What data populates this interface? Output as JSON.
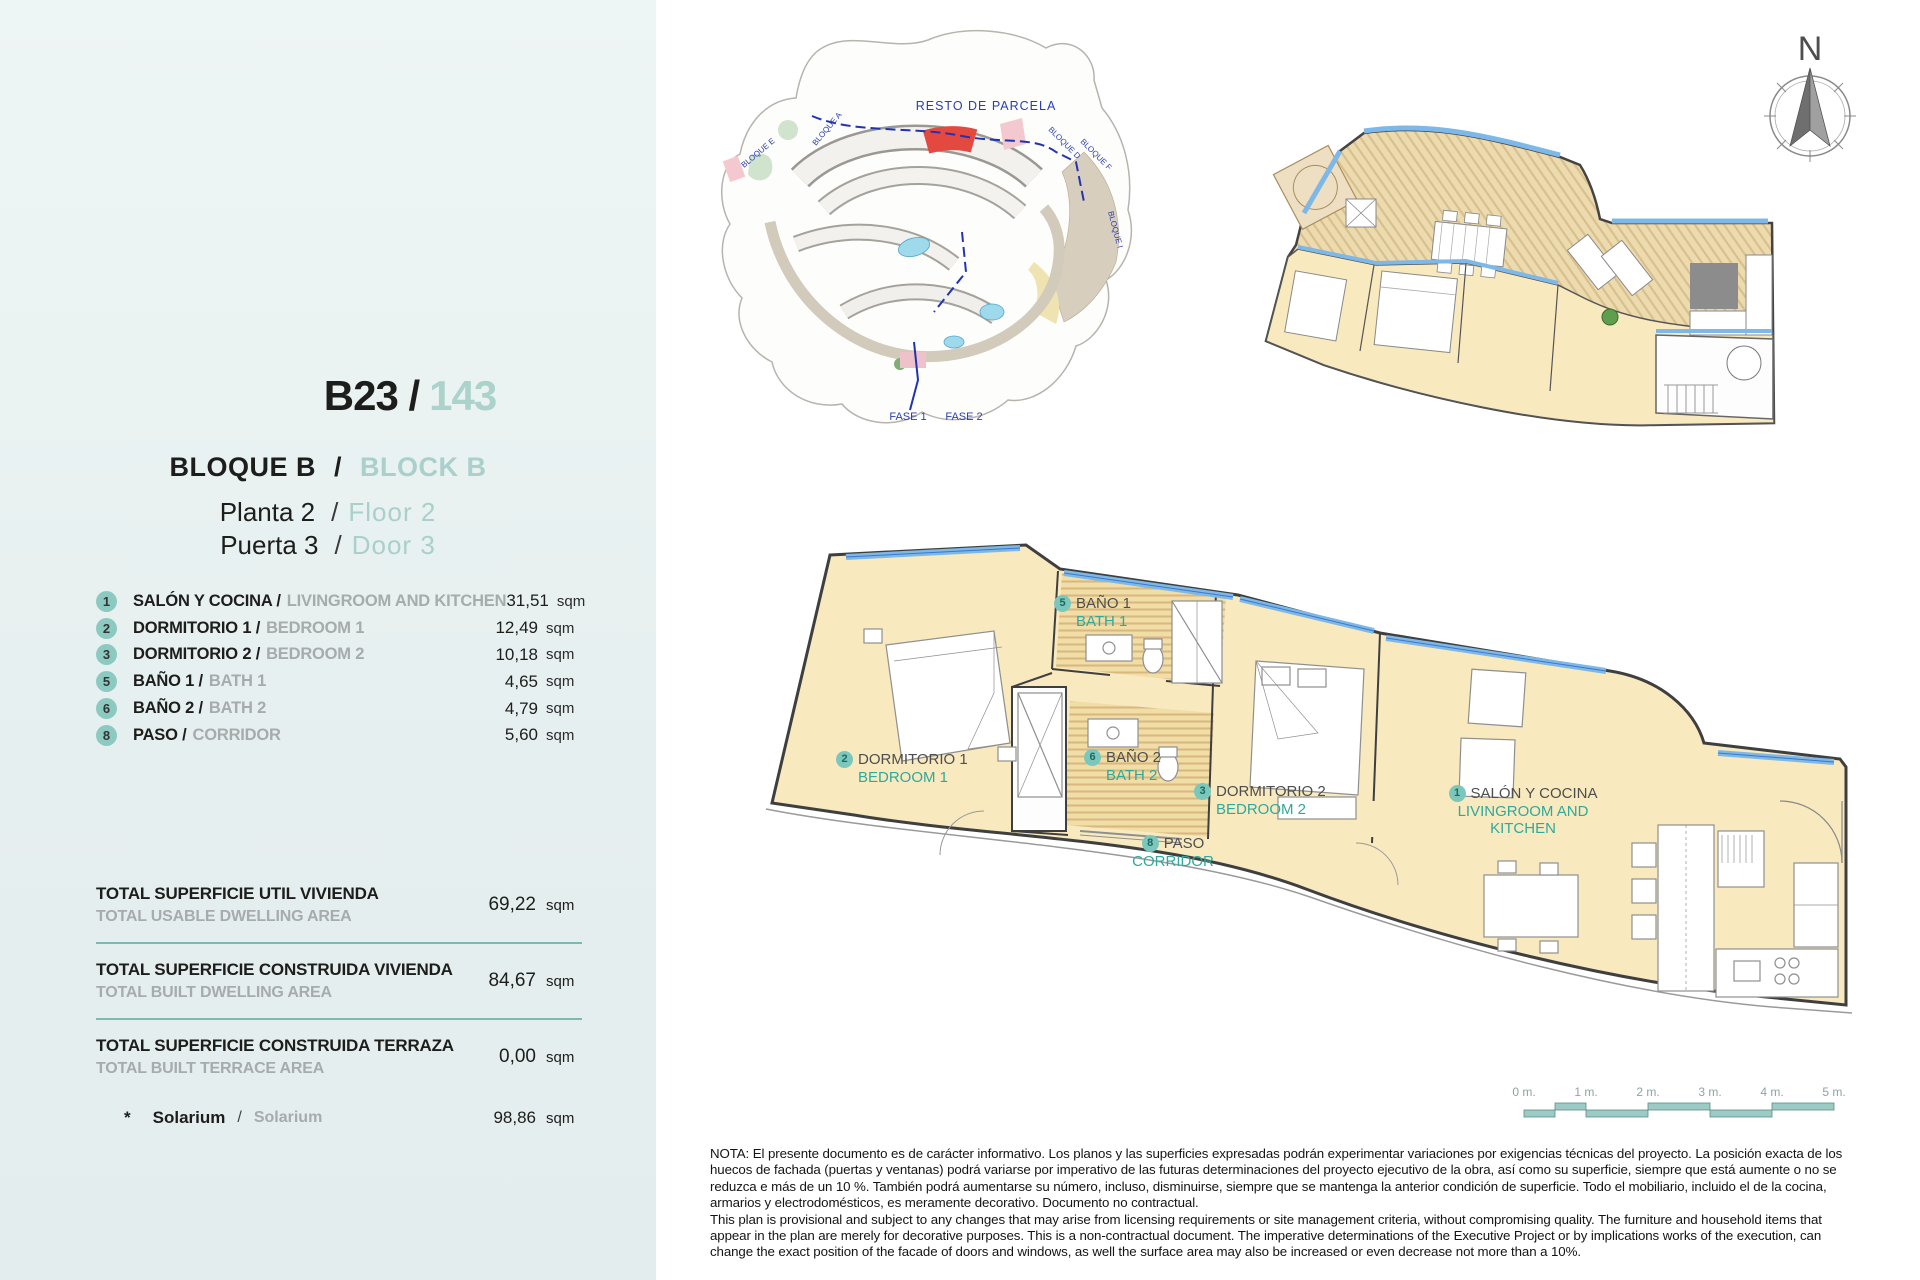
{
  "sidebar": {
    "unit": {
      "code": "B23 /",
      "number": "143"
    },
    "block": {
      "es": "BLOQUE B",
      "sep": "/",
      "en": "BLOCK B"
    },
    "floor": {
      "es": "Planta 2",
      "sep": "/",
      "en": "Floor 2"
    },
    "door": {
      "es": "Puerta 3",
      "sep": "/",
      "en": "Door 3"
    },
    "rooms": [
      {
        "num": "1",
        "es": "SALÓN Y COCINA /",
        "en": "LIVINGROOM AND KITCHEN",
        "value": "31,51",
        "unit": "sqm"
      },
      {
        "num": "2",
        "es": "DORMITORIO 1 /",
        "en": "BEDROOM 1",
        "value": "12,49",
        "unit": "sqm"
      },
      {
        "num": "3",
        "es": "DORMITORIO 2 /",
        "en": "BEDROOM 2",
        "value": "10,18",
        "unit": "sqm"
      },
      {
        "num": "5",
        "es": "BAÑO 1 /",
        "en": "BATH 1",
        "value": "4,65",
        "unit": "sqm"
      },
      {
        "num": "6",
        "es": "BAÑO 2 /",
        "en": "BATH 2",
        "value": "4,79",
        "unit": "sqm"
      },
      {
        "num": "8",
        "es": "PASO /",
        "en": "CORRIDOR",
        "value": "5,60",
        "unit": "sqm"
      }
    ],
    "totals": [
      {
        "es": "TOTAL SUPERFICIE UTIL VIVIENDA",
        "en": "TOTAL USABLE DWELLING AREA",
        "value": "69,22",
        "unit": "sqm"
      },
      {
        "es": "TOTAL SUPERFICIE CONSTRUIDA VIVIENDA",
        "en": "TOTAL BUILT DWELLING AREA",
        "value": "84,67",
        "unit": "sqm"
      },
      {
        "es": "TOTAL SUPERFICIE CONSTRUIDA TERRAZA",
        "en": "TOTAL BUILT TERRACE AREA",
        "value": "0,00",
        "unit": "sqm"
      }
    ],
    "solarium": {
      "star": "*",
      "es": "Solarium",
      "sep": "/",
      "en": "Solarium",
      "value": "98,86",
      "unit": "sqm"
    }
  },
  "site_plan": {
    "resto": "RESTO DE PARCELA",
    "fase1": "FASE 1",
    "fase2": "FASE 2",
    "bloques": [
      "BLOQUE E",
      "BLOQUE A",
      "BLOQUE D",
      "BLOQUE F",
      "BLOQUE I"
    ]
  },
  "compass": {
    "north": "N"
  },
  "plan_labels": [
    {
      "num": "1",
      "es": "SALÓN Y COCINA",
      "en": "LIVINGROOM AND KITCHEN"
    },
    {
      "num": "2",
      "es": "DORMITORIO 1",
      "en": "BEDROOM 1"
    },
    {
      "num": "3",
      "es": "DORMITORIO 2",
      "en": "BEDROOM 2"
    },
    {
      "num": "5",
      "es": "BAÑO 1",
      "en": "BATH 1"
    },
    {
      "num": "6",
      "es": "BAÑO 2",
      "en": "BATH 2"
    },
    {
      "num": "8",
      "es": "PASO",
      "en": "CORRIDOR"
    }
  ],
  "scale_bar": {
    "ticks": [
      "0 m.",
      "1 m.",
      "2 m.",
      "3 m.",
      "4 m.",
      "5 m."
    ]
  },
  "note": {
    "lines": [
      "NOTA: El presente documento es de carácter informativo. Los planos y las superficies expresadas podrán experimentar variaciones por exigencias técnicas del proyecto. La posición exacta de los",
      "huecos de fachada (puertas y ventanas) podrá variarse por imperativo de las futuras determinaciones del proyecto ejecutivo de la obra, así como su superficie, siempre que está aumente o no se",
      "reduzca e más de un 10 %. También podrá aumentarse su número, incluso, disminuirse, siempre que se mantenga la anterior condición de superficie. Todo el mobiliario, incluido el de la cocina,",
      "armarios y electrodomésticos, es meramente decorativo. Documento no contractual.",
      "This plan is provisional and subject to any changes that may arise from licensing requirements or site management criteria, without compromising quality. The furniture and household items that",
      "appear in the plan are merely for decorative purposes. This is a non-contractual document. The imperative determinations of the Executive Project or by implications works of the execution, can",
      "change the exact position of the facade of doors and windows, as well the surface area may also be increased or even decrease not more than a 10%."
    ]
  },
  "colors": {
    "accent_teal": "#7cc7bc",
    "label_teal": "#2fa99b",
    "muted_teal": "#a9d0ca",
    "floor_yellow": "#f8e9bf",
    "window_blue": "#7db8e8",
    "highlight_red": "#e4493f",
    "site_blue": "#2b3db5"
  }
}
